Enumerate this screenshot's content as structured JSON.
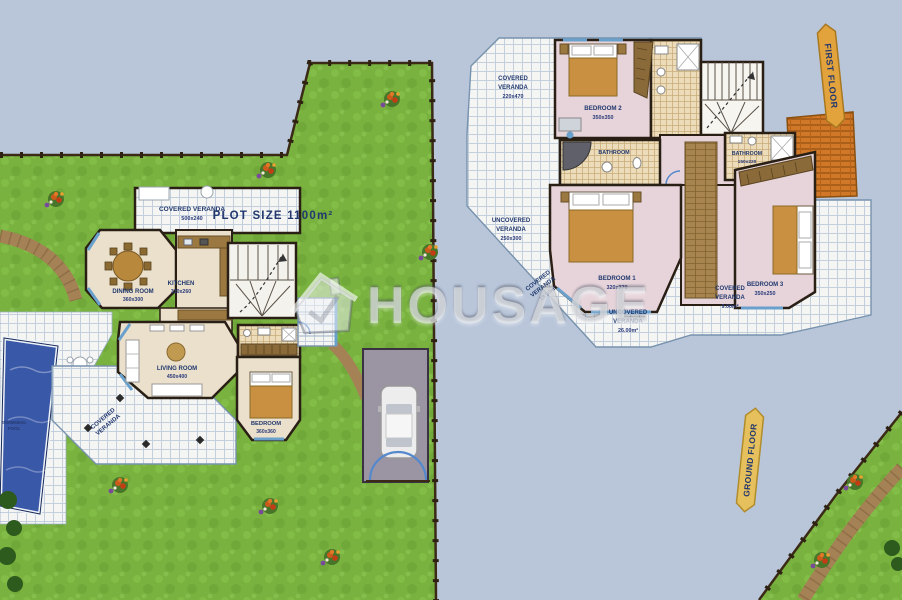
{
  "watermark": {
    "brand": "HOUSAGE",
    "icon": "house-icon"
  },
  "ribbons": {
    "first_floor": "FIRST FLOOR",
    "ground_floor": "GROUND FLOOR"
  },
  "ground_floor": {
    "plot_size": "PLOT SIZE 1100m²",
    "pool": {
      "l1": "SWIMMING",
      "l2": "POOL"
    },
    "veranda_top": {
      "name": "COVERED VERANDA",
      "dims": "500x240"
    },
    "dining": {
      "name": "DINING ROOM",
      "dims": "360x300"
    },
    "kitchen": {
      "name": "KITCHEN",
      "dims": "310x260"
    },
    "living": {
      "name": "LIVING ROOM",
      "dims": "450x400"
    },
    "bedroom": {
      "name": "BEDROOM",
      "dims": "360x360"
    },
    "veranda_bottom": {
      "l1": "COVERED",
      "l2": "VERANDA"
    }
  },
  "first_floor": {
    "veranda_tl": {
      "l1": "COVERED",
      "l2": "VERANDA",
      "dims": "220x470"
    },
    "veranda_left": {
      "l1": "UNCOVERED",
      "l2": "VERANDA",
      "dims": "250x300"
    },
    "bedroom2": {
      "name": "BEDROOM 2",
      "dims": "350x350"
    },
    "bedroom1": {
      "name": "BEDROOM 1",
      "dims": "320x370"
    },
    "bedroom3": {
      "name": "BEDROOM 3",
      "dims": "350x250"
    },
    "bathroom": {
      "name": "BATHROOM"
    },
    "shower_room": {
      "name": "BATHROOM",
      "dims": "150x220"
    },
    "veranda_bl": {
      "l1": "COVERED",
      "l2": "VERANDA",
      "dims": "19.00m²"
    },
    "veranda_bottom": {
      "l1": "UNCOVERED",
      "l2": "VERANDA",
      "dims": "26.00m²"
    },
    "veranda_br": {
      "l1": "COVERED",
      "l2": "VERANDA",
      "dims": "9.00m²"
    }
  },
  "colors": {
    "sky": "#b9c6da",
    "grass": "#79b23f",
    "pool": "#3a58a8",
    "wall": "#2a1f14",
    "room_pink": "#e6d4da",
    "room_beige": "#eae0cc",
    "ribbon": "#e2a23c",
    "label": "#22386e"
  }
}
